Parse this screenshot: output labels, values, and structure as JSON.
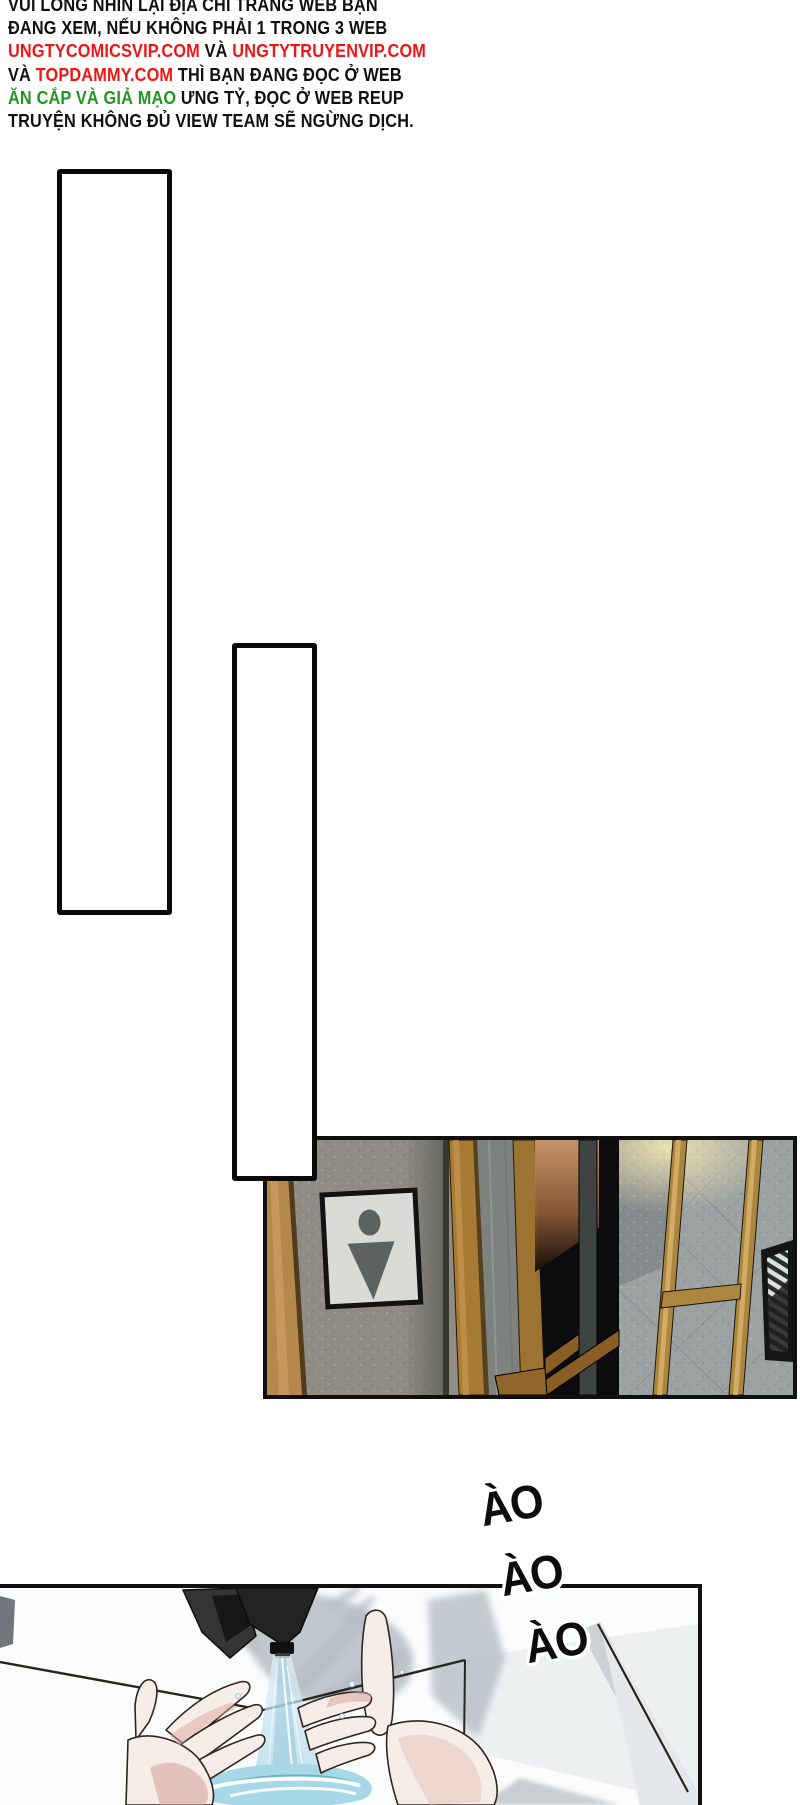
{
  "warning": {
    "lines": [
      {
        "segments": [
          {
            "text": "VUI LÒNG NHÌN LẠI ĐỊA CHỈ TRANG WEB BẠN",
            "color": "black"
          }
        ]
      },
      {
        "segments": [
          {
            "text": "ĐANG XEM, NẾU KHÔNG PHẢI 1 TRONG 3 WEB",
            "color": "black"
          }
        ]
      },
      {
        "segments": [
          {
            "text": "UNGTYCOMICSVIP.COM",
            "color": "red"
          },
          {
            "text": " VÀ ",
            "color": "black"
          },
          {
            "text": "UNGTYTRUYENVIP.COM",
            "color": "red"
          }
        ]
      },
      {
        "segments": [
          {
            "text": "VÀ ",
            "color": "black"
          },
          {
            "text": "TOPDAMMY.COM",
            "color": "red"
          },
          {
            "text": " THÌ BẠN ĐANG ĐỌC Ở WEB",
            "color": "black"
          }
        ]
      },
      {
        "segments": [
          {
            "text": "ĂN CẮP VÀ GIẢ MẠO",
            "color": "green"
          },
          {
            "text": " ƯNG TỶ, ĐỌC Ở WEB REUP",
            "color": "black"
          }
        ]
      },
      {
        "segments": [
          {
            "text": "TRUYỆN KHÔNG ĐỦ VIEW TEAM SẼ NGỪNG DỊCH.",
            "color": "black"
          }
        ]
      }
    ]
  },
  "sfx": {
    "items": [
      "ÀO",
      "ÀO",
      "ÀO"
    ]
  },
  "icons": {
    "restroom_sign": "male-restroom-icon"
  },
  "palette": {
    "red": "#ed1515",
    "green": "#23961f",
    "text_black": "#101010",
    "panel_border": "#101010",
    "wood": "#b5874b",
    "wall_gray": "#8e8c84",
    "tile_gray": "#9ca1a2",
    "gold": "#ab863f",
    "doorway_black": "#0c0c0e",
    "copper_glow": "#cf9a6e",
    "sign_bg": "#dadad7",
    "sign_icon": "#5d615f",
    "water_blue": "#a6d8e8",
    "stream_blue": "#9fd0e2",
    "skin": "#f6ece8",
    "skin_shade": "#d9a79e",
    "shadow_gray": "#b7bdc6"
  }
}
